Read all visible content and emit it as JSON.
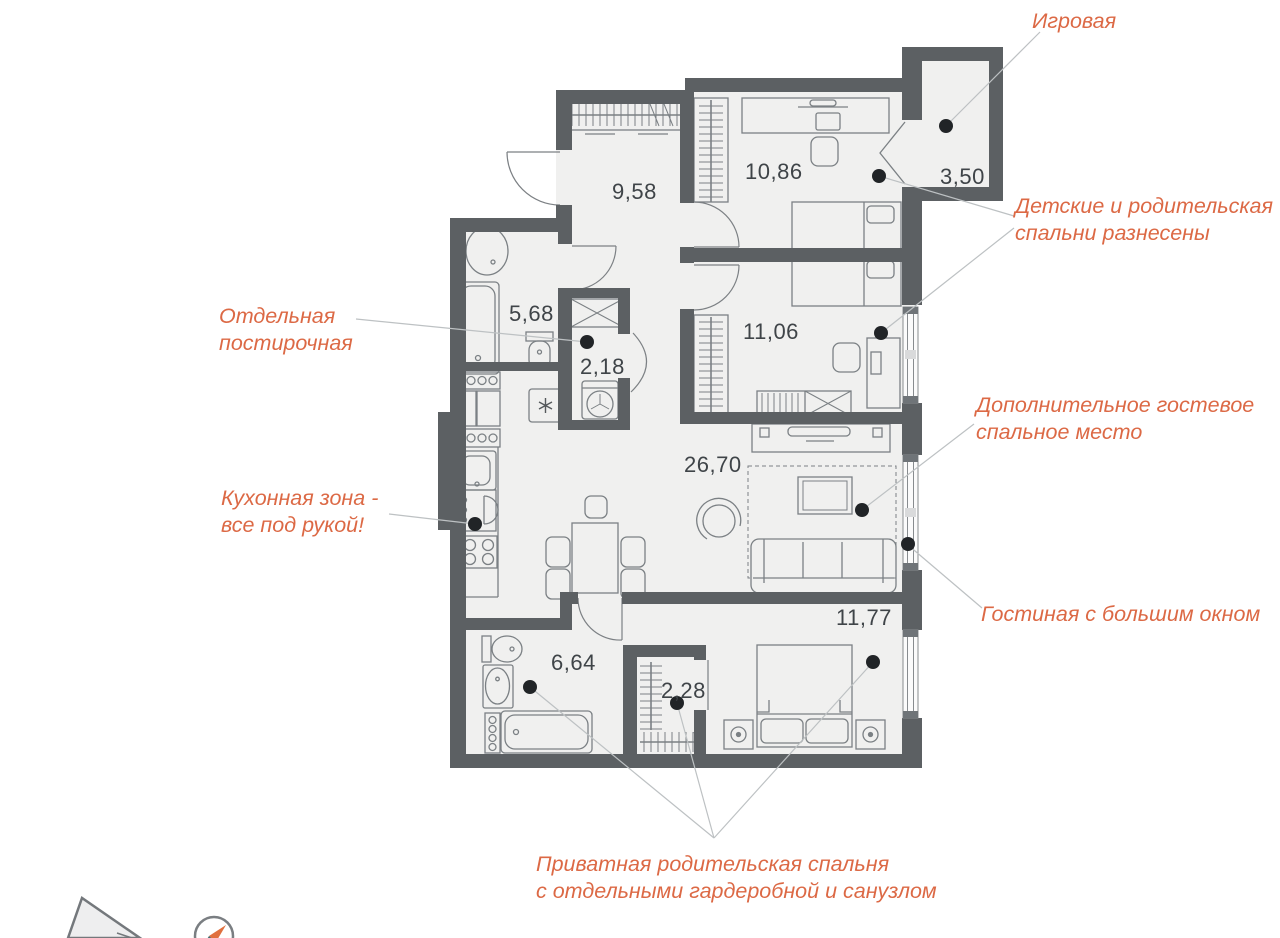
{
  "plan": {
    "rooms": [
      {
        "key": "hallway",
        "area": "9,58"
      },
      {
        "key": "children-bedroom-1",
        "area": "10,86"
      },
      {
        "key": "playroom",
        "area": "3,50"
      },
      {
        "key": "bathroom",
        "area": "5,68"
      },
      {
        "key": "laundry",
        "area": "2,18"
      },
      {
        "key": "children-bedroom-2",
        "area": "11,06"
      },
      {
        "key": "living-kitchen",
        "area": "26,70"
      },
      {
        "key": "master-bathroom",
        "area": "6,64"
      },
      {
        "key": "master-wardrobe",
        "area": "2,28"
      },
      {
        "key": "master-bedroom",
        "area": "11,77"
      }
    ],
    "annotations": [
      {
        "key": "playroom-note",
        "text": "Игровая"
      },
      {
        "key": "separated-bedrooms",
        "text": "Детские и родительская\nспальни разнесены"
      },
      {
        "key": "laundry-note",
        "text": "Отдельная\nпостирочная"
      },
      {
        "key": "guest-sleeping",
        "text": "Дополнительное гостевое\nспальное место"
      },
      {
        "key": "kitchen-note",
        "text": "Кухонная зона -\nвсе под рукой!"
      },
      {
        "key": "living-window",
        "text": "Гостиная с большим окном"
      },
      {
        "key": "private-master",
        "text": "Приватная родительская спальня\nс отдельными гардеробной и санузлом"
      }
    ],
    "icons": [
      "compass-icon",
      "snowflake-fridge-icon",
      "washing-machine-icon",
      "building-footprint-icon"
    ],
    "colors": {
      "wall": "#5c6063",
      "floor": "#f0f0ef",
      "annotation": "#dc6945",
      "leader": "#bdc1c3",
      "dot": "#212427",
      "room_label": "#3f4448",
      "furniture": "#7b8084",
      "compass_north": "#e0703f",
      "compass_south": "#3f6a72"
    }
  }
}
